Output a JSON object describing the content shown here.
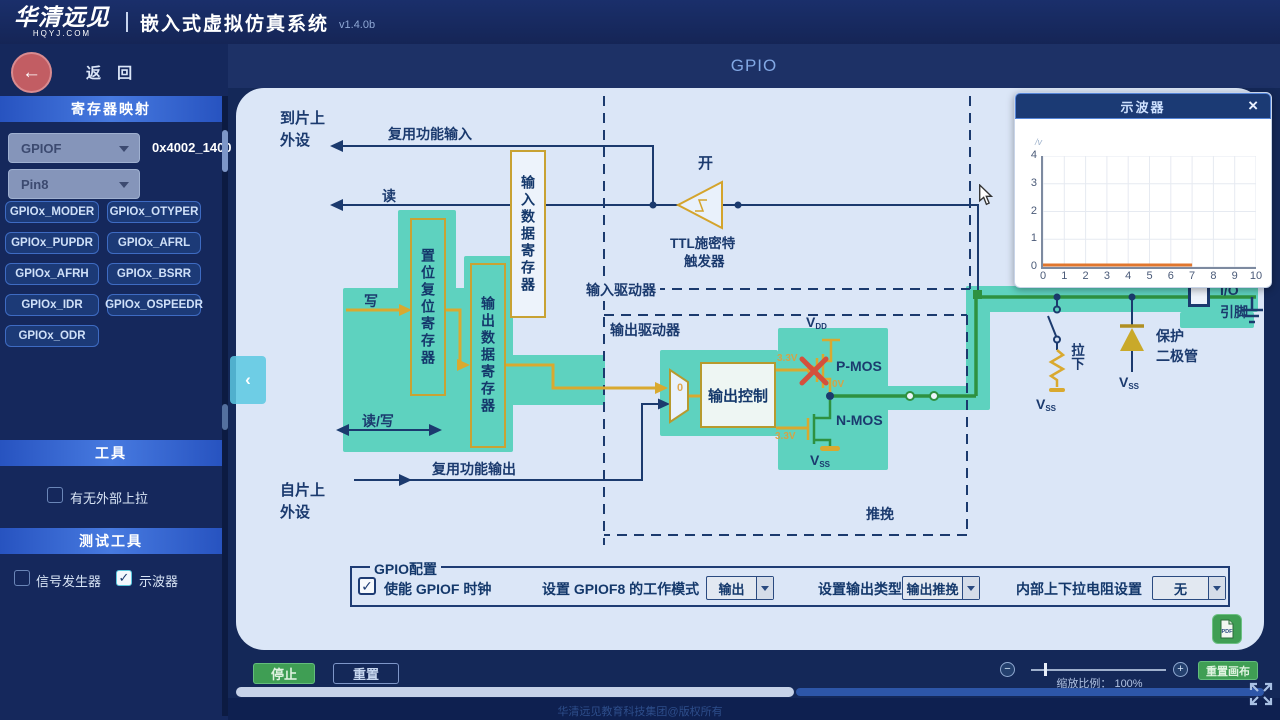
{
  "header": {
    "logo_main": "华清远见",
    "logo_sub": "HQYJ.COM",
    "app_title": "嵌入式虚拟仿真系统",
    "version": "v1.4.0b"
  },
  "sidebar": {
    "back_label": "返 回",
    "register_map_title": "寄存器映射",
    "port_value": "GPIOF",
    "port_address": "0x4002_1400",
    "pin_value": "Pin8",
    "register_buttons": [
      "GPIOx_MODER",
      "GPIOx_OTYPER",
      "GPIOx_PUPDR",
      "GPIOx_AFRL",
      "GPIOx_AFRH",
      "GPIOx_BSRR",
      "GPIOx_IDR",
      "GPIOx_OSPEEDR",
      "GPIOx_ODR"
    ],
    "tools_title": "工具",
    "external_pullup": {
      "label": "有无外部上拉",
      "checked": false
    },
    "test_tools_title": "测试工具",
    "signal_generator": {
      "label": "信号发生器",
      "checked": false
    },
    "oscilloscope": {
      "label": "示波器",
      "checked": true
    }
  },
  "main": {
    "title": "GPIO"
  },
  "diagram": {
    "to_chip_line1": "到片上",
    "to_chip_line2": "外设",
    "alt_func_input": "复用功能输入",
    "read": "读",
    "write": "写",
    "read_write": "读/写",
    "alt_func_output": "复用功能输出",
    "from_chip_line1": "自片上",
    "from_chip_line2": "外设",
    "input_data_register": "输入数据寄存器",
    "set_reset_register": "置位复位寄存器",
    "output_data_register": "输出数据寄存器",
    "on_label": "开",
    "ttl_line1": "TTL施密特",
    "ttl_line2": "触发器",
    "input_driver": "输入驱动器",
    "output_driver": "输出驱动器",
    "output_control": "输出控制",
    "push_pull": "推挽",
    "mux_select": "0",
    "v_main": "V",
    "vdd_sub": "DD",
    "vss_sub": "SS",
    "pmos": "P-MOS",
    "nmos": "N-MOS",
    "v33": "3.3V",
    "v0": "0V",
    "pull_down": "拉下",
    "protect_line1": "保护",
    "protect_line2": "二极管",
    "io_line1": "I/O",
    "io_line2": "引脚"
  },
  "config": {
    "legend": "GPIO配置",
    "clock": {
      "label": "使能 GPIOF  时钟",
      "checked": true
    },
    "mode": {
      "label": "设置 GPIOF8 的工作模式",
      "value": "输出"
    },
    "type": {
      "label": "设置输出类型",
      "value": "输出推挽"
    },
    "pull": {
      "label": "内部上下拉电阻设置",
      "value": "无"
    }
  },
  "scope": {
    "title": "示波器",
    "close": "×",
    "y_unit": "/v"
  },
  "controls": {
    "stop": "停止",
    "reset": "重置",
    "zoom_label": "缩放比例： 100%",
    "reset_canvas": "重置画布",
    "minus": "−",
    "plus": "+",
    "collapse": "‹",
    "pdf": "PDF"
  },
  "footer": {
    "copyright": "华清远见教育科技集团@版权所有"
  },
  "chart_data": {
    "type": "line",
    "title": "示波器",
    "xlabel": "",
    "ylabel": "/v",
    "xlim": [
      0,
      10
    ],
    "ylim": [
      0,
      4
    ],
    "x_ticks": [
      0,
      1,
      2,
      3,
      4,
      5,
      6,
      7,
      8,
      9,
      10
    ],
    "y_ticks": [
      0,
      1,
      2,
      3,
      4
    ],
    "grid": true,
    "legend_position": "none",
    "series": [
      {
        "name": "gpio-pin-voltage",
        "color": "#e0762e",
        "points": [
          [
            0,
            0
          ],
          [
            7,
            0
          ]
        ]
      }
    ]
  }
}
